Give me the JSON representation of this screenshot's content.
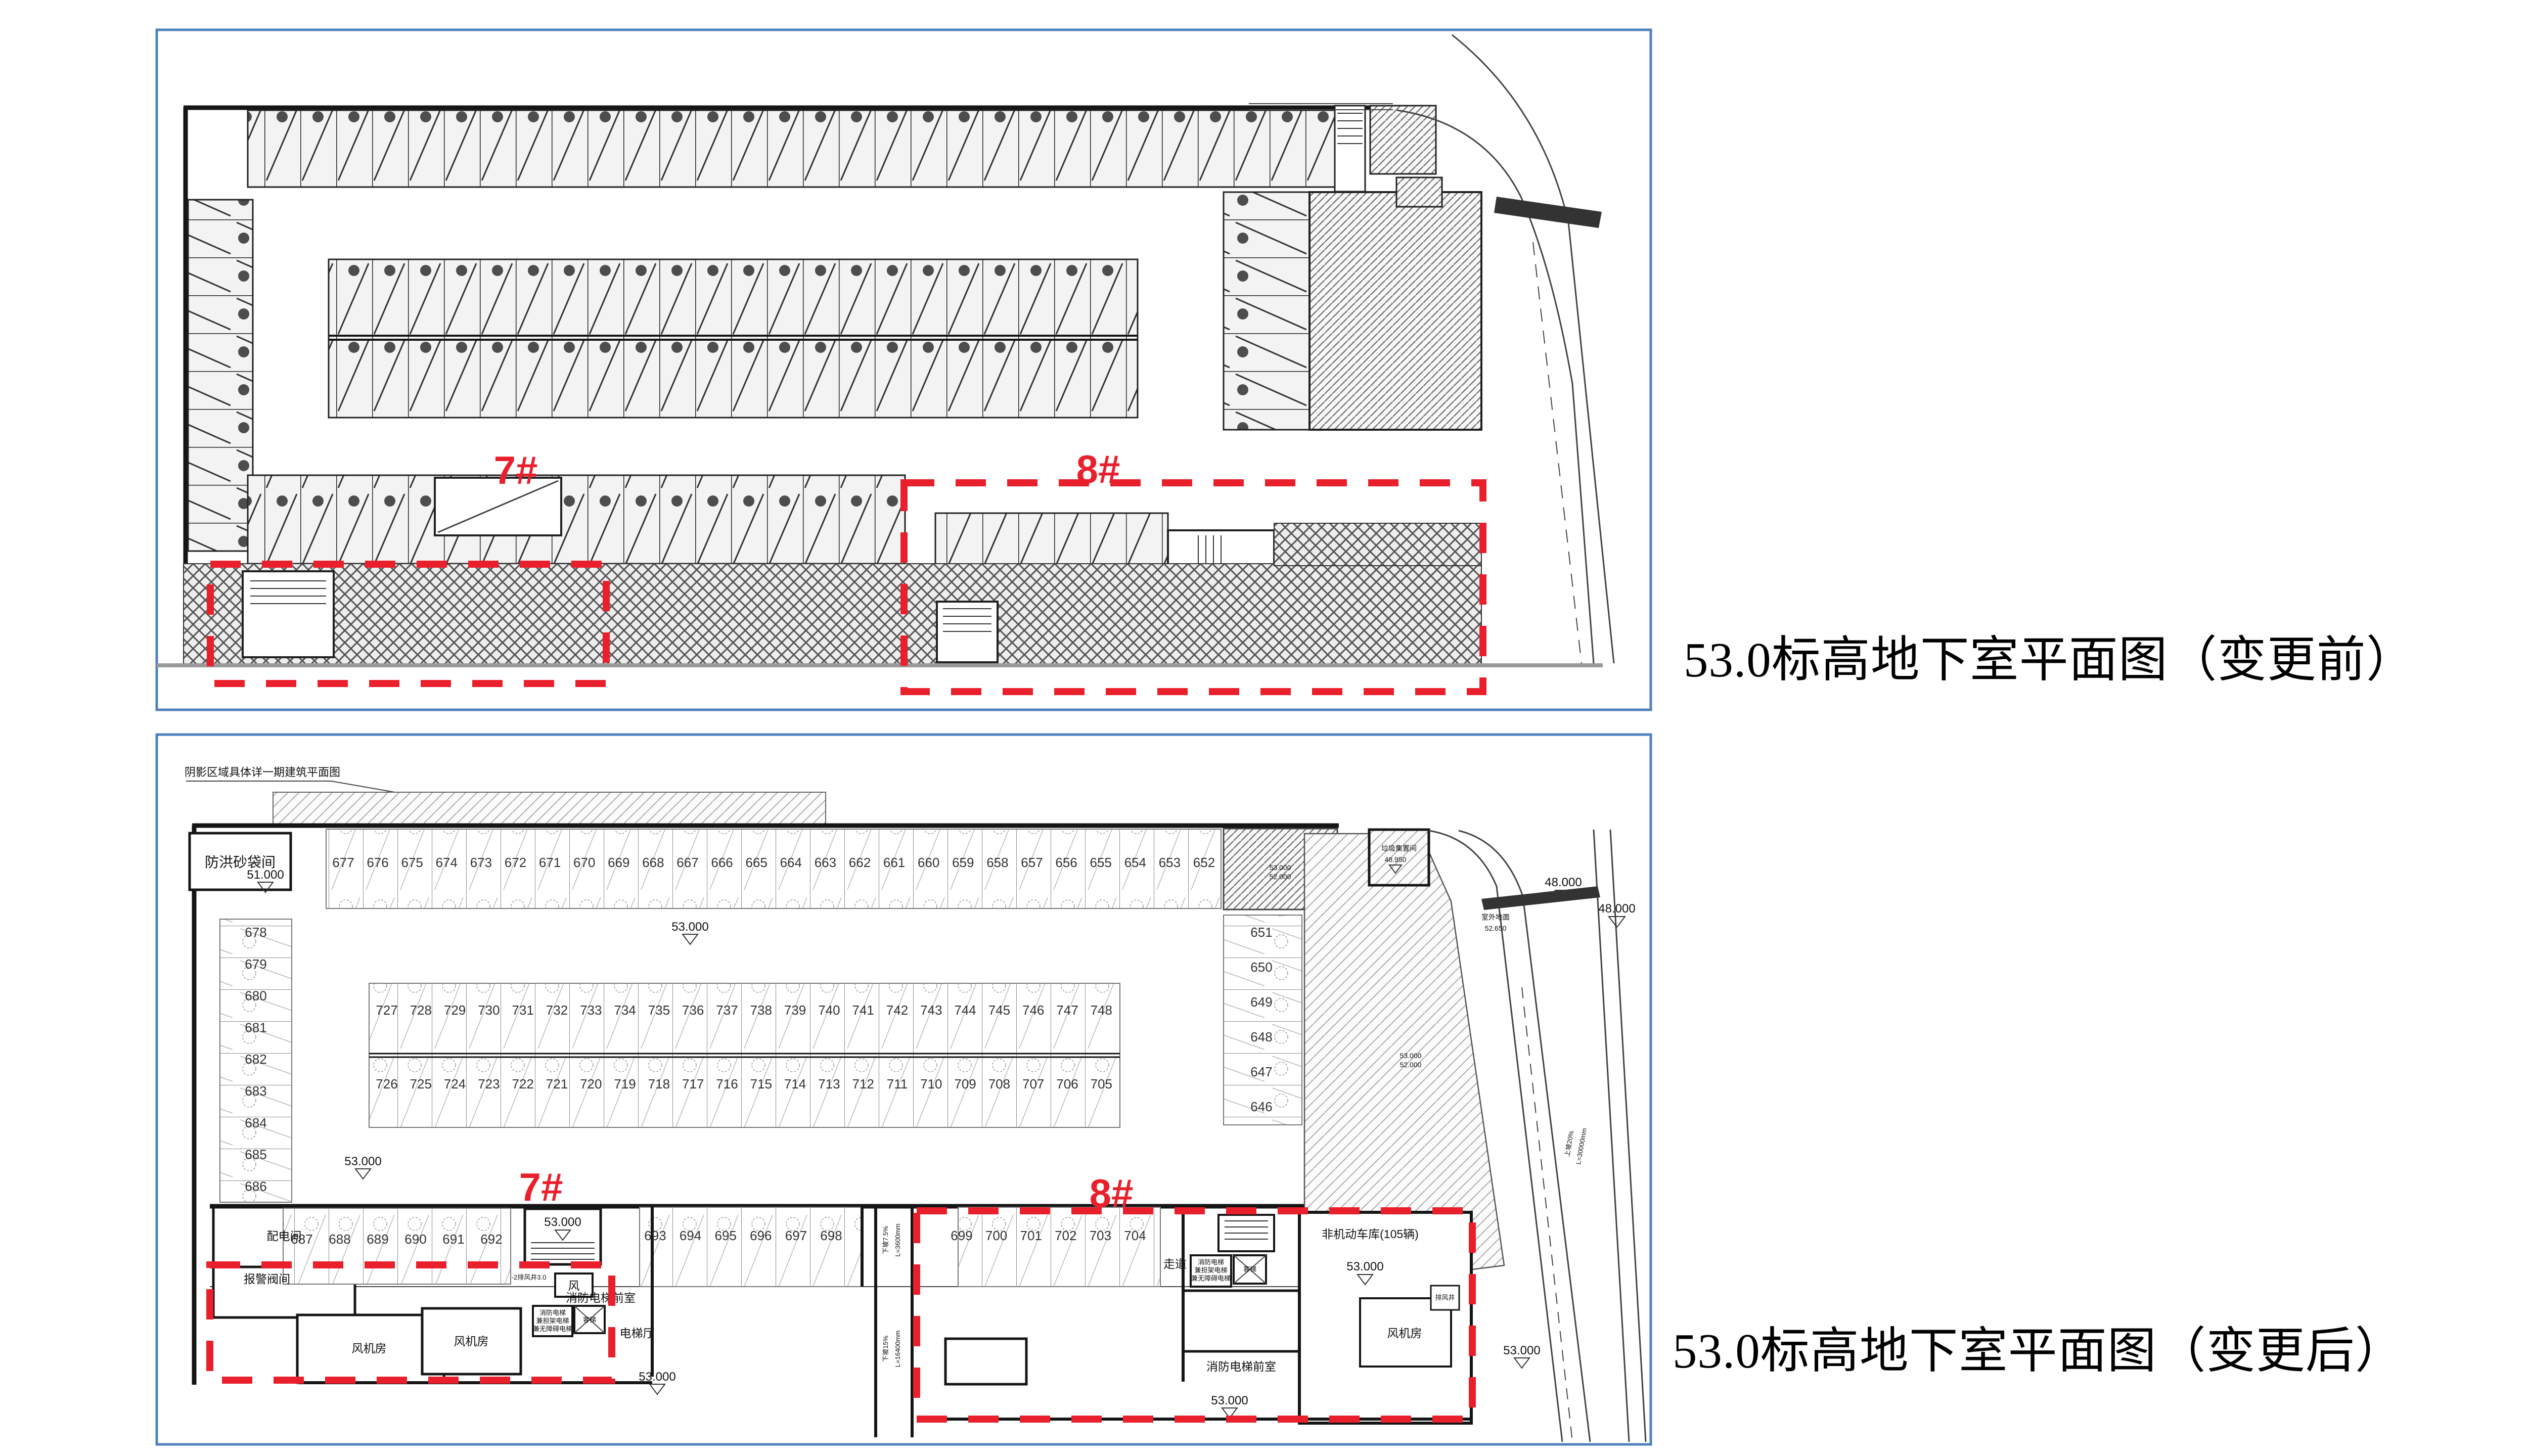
{
  "captions": {
    "before": "53.0标高地下室平面图（变更前）",
    "after": "53.0标高地下室平面图（变更后）"
  },
  "colors": {
    "highlight_red": "#E9202C",
    "panel_border_blue": "#4F81BD"
  },
  "top_plan": {
    "label_7": "7#",
    "label_8": "8#"
  },
  "bottom_plan": {
    "label_7": "7#",
    "label_8": "8#",
    "note_top_left": "阴影区域具体详一期建筑平面图",
    "rooms": {
      "flood_sandbag_room": "防洪砂袋间",
      "power_room_1": "配电间",
      "alarm_valve_room": "报警阀间",
      "fan_room_1": "风机房",
      "fan_room_2": "风机房",
      "fan_room_3": "风机房",
      "fire_elevator_lobby": "消防电梯前室",
      "elevator_hall": "电梯厅",
      "passenger_elevator": "客梯",
      "fire_elevator_note_l1": "消防电梯",
      "fire_elevator_note_l2": "兼担架电梯",
      "fire_elevator_note_l3": "兼无障碍电梯",
      "wind_shaft": "风",
      "exhaust_shaft": "排风井",
      "exhaust_note": "-2排风井3.0",
      "corridor": "走道",
      "bike_garage": "非机动车库(105辆)",
      "trash_room": "垃圾集置间",
      "outdoor_ground": "室外地面"
    },
    "elevations": {
      "e53": "53.000",
      "e51": "51.000",
      "e52": "52.000",
      "e48": "48.000",
      "e48_95": "48.950",
      "e52_65": "52.650"
    },
    "ramps": {
      "down1_grade": "下坡7.5%",
      "down1_len": "L=3600mm",
      "down2_grade": "下坡15%",
      "down2_len": "L=16400mm",
      "up_grade": "上坡20%",
      "up_len": "L=30000mm"
    },
    "parking": {
      "top_row": [
        "677",
        "676",
        "675",
        "674",
        "673",
        "672",
        "671",
        "670",
        "669",
        "668",
        "667",
        "666",
        "665",
        "664",
        "663",
        "662",
        "661",
        "660",
        "659",
        "658",
        "657",
        "656",
        "655",
        "654",
        "653",
        "652"
      ],
      "left_column": [
        "678",
        "679",
        "680",
        "681",
        "682",
        "683",
        "684",
        "685",
        "686"
      ],
      "island_top": [
        "727",
        "728",
        "729",
        "730",
        "731",
        "732",
        "733",
        "734",
        "735",
        "736",
        "737",
        "738",
        "739",
        "740",
        "741",
        "742",
        "743",
        "744",
        "745",
        "746",
        "747",
        "748"
      ],
      "island_bottom": [
        "726",
        "725",
        "724",
        "723",
        "722",
        "721",
        "720",
        "719",
        "718",
        "717",
        "716",
        "715",
        "714",
        "713",
        "712",
        "711",
        "710",
        "709",
        "708",
        "707",
        "706",
        "705"
      ],
      "right_column": [
        "651",
        "650",
        "649",
        "648",
        "647",
        "646"
      ],
      "row_687_692": [
        "687",
        "688",
        "689",
        "690",
        "691",
        "692"
      ],
      "row_693_698": [
        "693",
        "694",
        "695",
        "696",
        "697",
        "698"
      ],
      "row_699_704": [
        "699",
        "700",
        "701",
        "702",
        "703",
        "704"
      ]
    }
  }
}
